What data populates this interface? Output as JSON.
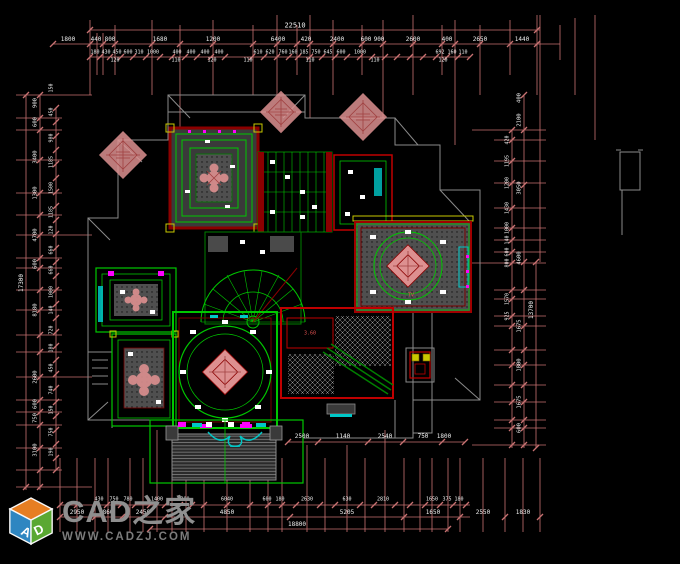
{
  "colors": {
    "background": "#000000",
    "dim_line": "#c87272",
    "dim_text": "#f0f0f0",
    "green": "#00c800",
    "green_dark": "#008000",
    "red": "#c00000",
    "red_dark": "#8b0000",
    "pink": "#dd9090",
    "magenta": "#ff00ff",
    "cyan": "#00c8c8",
    "yellow": "#c8c800",
    "gray": "#8a8a8a",
    "gray_dark": "#555555",
    "logo_text": "#8f8f8f",
    "logo_url": "#7c7c7c",
    "logo_blue": "#2e86c1",
    "logo_green": "#5aa832",
    "logo_orange": "#e67e22"
  },
  "watermark": {
    "cube_left_letter": "A",
    "cube_right_letter": "D",
    "title": "CAD之家",
    "url": "WWW.CADZJ.COM"
  },
  "plan_labels": [
    {
      "t": "3.60",
      "x": 310,
      "y": 334
    },
    {
      "t": "TV",
      "x": 411,
      "y": 296
    }
  ],
  "dimensions": {
    "horizontal": [
      {
        "t": "22510",
        "x": 295,
        "y": 26,
        "s": 7
      },
      {
        "t": "1800",
        "x": 68,
        "y": 40,
        "s": 6
      },
      {
        "t": "440",
        "x": 96,
        "y": 40,
        "s": 6
      },
      {
        "t": "800",
        "x": 110,
        "y": 40,
        "s": 6
      },
      {
        "t": "1680",
        "x": 160,
        "y": 40,
        "s": 6
      },
      {
        "t": "1200",
        "x": 213,
        "y": 40,
        "s": 6
      },
      {
        "t": "6400",
        "x": 278,
        "y": 40,
        "s": 6
      },
      {
        "t": "420",
        "x": 306,
        "y": 40,
        "s": 6
      },
      {
        "t": "2400",
        "x": 337,
        "y": 40,
        "s": 6
      },
      {
        "t": "600",
        "x": 366,
        "y": 40,
        "s": 6
      },
      {
        "t": "900",
        "x": 379,
        "y": 40,
        "s": 6
      },
      {
        "t": "2600",
        "x": 413,
        "y": 40,
        "s": 6
      },
      {
        "t": "400",
        "x": 447,
        "y": 40,
        "s": 6
      },
      {
        "t": "2650",
        "x": 480,
        "y": 40,
        "s": 6
      },
      {
        "t": "1440",
        "x": 522,
        "y": 40,
        "s": 6
      },
      {
        "t": "180",
        "x": 95,
        "y": 53,
        "s": 5
      },
      {
        "t": "430",
        "x": 106,
        "y": 53,
        "s": 5
      },
      {
        "t": "450",
        "x": 117,
        "y": 53,
        "s": 5
      },
      {
        "t": "600",
        "x": 128,
        "y": 53,
        "s": 5
      },
      {
        "t": "310",
        "x": 139,
        "y": 53,
        "s": 5
      },
      {
        "t": "1000",
        "x": 153,
        "y": 53,
        "s": 5
      },
      {
        "t": "400",
        "x": 177,
        "y": 53,
        "s": 5
      },
      {
        "t": "400",
        "x": 191,
        "y": 53,
        "s": 5
      },
      {
        "t": "400",
        "x": 205,
        "y": 53,
        "s": 5
      },
      {
        "t": "400",
        "x": 219,
        "y": 53,
        "s": 5
      },
      {
        "t": "610",
        "x": 258,
        "y": 53,
        "s": 5
      },
      {
        "t": "620",
        "x": 270,
        "y": 53,
        "s": 5
      },
      {
        "t": "760",
        "x": 283,
        "y": 53,
        "s": 5
      },
      {
        "t": "160",
        "x": 293,
        "y": 53,
        "s": 5
      },
      {
        "t": "185",
        "x": 304,
        "y": 53,
        "s": 5
      },
      {
        "t": "750",
        "x": 316,
        "y": 53,
        "s": 5
      },
      {
        "t": "645",
        "x": 328,
        "y": 53,
        "s": 5
      },
      {
        "t": "600",
        "x": 341,
        "y": 53,
        "s": 5
      },
      {
        "t": "1000",
        "x": 360,
        "y": 53,
        "s": 5
      },
      {
        "t": "692",
        "x": 440,
        "y": 53,
        "s": 5
      },
      {
        "t": "160",
        "x": 452,
        "y": 53,
        "s": 5
      },
      {
        "t": "110",
        "x": 463,
        "y": 53,
        "s": 5
      },
      {
        "t": "120",
        "x": 115,
        "y": 61,
        "s": 5
      },
      {
        "t": "110",
        "x": 176,
        "y": 61,
        "s": 5
      },
      {
        "t": "120",
        "x": 212,
        "y": 61,
        "s": 5
      },
      {
        "t": "110",
        "x": 248,
        "y": 61,
        "s": 5
      },
      {
        "t": "110",
        "x": 310,
        "y": 61,
        "s": 5
      },
      {
        "t": "110",
        "x": 375,
        "y": 61,
        "s": 5
      },
      {
        "t": "120",
        "x": 443,
        "y": 61,
        "s": 5
      },
      {
        "t": "2500",
        "x": 302,
        "y": 437,
        "s": 6
      },
      {
        "t": "1140",
        "x": 343,
        "y": 437,
        "s": 6
      },
      {
        "t": "2540",
        "x": 385,
        "y": 437,
        "s": 6
      },
      {
        "t": "750",
        "x": 423,
        "y": 437,
        "s": 6
      },
      {
        "t": "1800",
        "x": 444,
        "y": 437,
        "s": 6
      },
      {
        "t": "430",
        "x": 99,
        "y": 500,
        "s": 5
      },
      {
        "t": "750",
        "x": 114,
        "y": 500,
        "s": 5
      },
      {
        "t": "780",
        "x": 128,
        "y": 500,
        "s": 5
      },
      {
        "t": "1400",
        "x": 157,
        "y": 500,
        "s": 5
      },
      {
        "t": "300",
        "x": 185,
        "y": 500,
        "s": 5
      },
      {
        "t": "6040",
        "x": 227,
        "y": 500,
        "s": 5
      },
      {
        "t": "600",
        "x": 267,
        "y": 500,
        "s": 5
      },
      {
        "t": "180",
        "x": 280,
        "y": 500,
        "s": 5
      },
      {
        "t": "2630",
        "x": 307,
        "y": 500,
        "s": 5
      },
      {
        "t": "630",
        "x": 347,
        "y": 500,
        "s": 5
      },
      {
        "t": "2810",
        "x": 383,
        "y": 500,
        "s": 5
      },
      {
        "t": "1650",
        "x": 432,
        "y": 500,
        "s": 5
      },
      {
        "t": "375",
        "x": 447,
        "y": 500,
        "s": 5
      },
      {
        "t": "180",
        "x": 459,
        "y": 500,
        "s": 5
      },
      {
        "t": "2950",
        "x": 77,
        "y": 513,
        "s": 6
      },
      {
        "t": "860",
        "x": 108,
        "y": 513,
        "s": 6
      },
      {
        "t": "2450",
        "x": 143,
        "y": 513,
        "s": 6
      },
      {
        "t": "4850",
        "x": 227,
        "y": 513,
        "s": 6
      },
      {
        "t": "5205",
        "x": 347,
        "y": 513,
        "s": 6
      },
      {
        "t": "1650",
        "x": 433,
        "y": 513,
        "s": 6
      },
      {
        "t": "2550",
        "x": 483,
        "y": 513,
        "s": 6
      },
      {
        "t": "1830",
        "x": 523,
        "y": 513,
        "s": 6
      },
      {
        "t": "18800",
        "x": 297,
        "y": 525,
        "s": 6
      }
    ],
    "vertical": [
      {
        "t": "17300",
        "x": 22,
        "y": 283,
        "s": 6
      },
      {
        "t": "900",
        "x": 36,
        "y": 103,
        "s": 5.5
      },
      {
        "t": "600",
        "x": 36,
        "y": 122,
        "s": 5.5
      },
      {
        "t": "3400",
        "x": 36,
        "y": 157,
        "s": 5.5
      },
      {
        "t": "1300",
        "x": 36,
        "y": 193,
        "s": 5.5
      },
      {
        "t": "4700",
        "x": 36,
        "y": 235,
        "s": 5.5
      },
      {
        "t": "600",
        "x": 36,
        "y": 264,
        "s": 5.5
      },
      {
        "t": "8180",
        "x": 36,
        "y": 310,
        "s": 5.5
      },
      {
        "t": "2600",
        "x": 36,
        "y": 377,
        "s": 5.5
      },
      {
        "t": "600",
        "x": 36,
        "y": 404,
        "s": 5.5
      },
      {
        "t": "750",
        "x": 36,
        "y": 418,
        "s": 5.5
      },
      {
        "t": "3100",
        "x": 36,
        "y": 450,
        "s": 5.5
      },
      {
        "t": "150",
        "x": 52,
        "y": 88,
        "s": 5
      },
      {
        "t": "450",
        "x": 52,
        "y": 112,
        "s": 5
      },
      {
        "t": "980",
        "x": 52,
        "y": 138,
        "s": 5
      },
      {
        "t": "1185",
        "x": 52,
        "y": 162,
        "s": 5
      },
      {
        "t": "1500",
        "x": 52,
        "y": 188,
        "s": 5
      },
      {
        "t": "1185",
        "x": 52,
        "y": 212,
        "s": 5
      },
      {
        "t": "120",
        "x": 52,
        "y": 230,
        "s": 5
      },
      {
        "t": "660",
        "x": 52,
        "y": 250,
        "s": 5
      },
      {
        "t": "660",
        "x": 52,
        "y": 270,
        "s": 5
      },
      {
        "t": "1000",
        "x": 52,
        "y": 292,
        "s": 5
      },
      {
        "t": "140",
        "x": 52,
        "y": 310,
        "s": 5
      },
      {
        "t": "720",
        "x": 52,
        "y": 330,
        "s": 5
      },
      {
        "t": "180",
        "x": 52,
        "y": 348,
        "s": 5
      },
      {
        "t": "450",
        "x": 52,
        "y": 368,
        "s": 5
      },
      {
        "t": "740",
        "x": 52,
        "y": 390,
        "s": 5
      },
      {
        "t": "150",
        "x": 52,
        "y": 410,
        "s": 5
      },
      {
        "t": "750",
        "x": 52,
        "y": 432,
        "s": 5
      },
      {
        "t": "190",
        "x": 52,
        "y": 452,
        "s": 5
      },
      {
        "t": "420",
        "x": 508,
        "y": 140,
        "s": 5
      },
      {
        "t": "1195",
        "x": 508,
        "y": 161,
        "s": 5
      },
      {
        "t": "1200",
        "x": 508,
        "y": 183,
        "s": 5
      },
      {
        "t": "1430",
        "x": 508,
        "y": 208,
        "s": 5
      },
      {
        "t": "1000",
        "x": 508,
        "y": 228,
        "s": 5
      },
      {
        "t": "140",
        "x": 508,
        "y": 240,
        "s": 5
      },
      {
        "t": "600",
        "x": 508,
        "y": 252,
        "s": 5
      },
      {
        "t": "800",
        "x": 508,
        "y": 263,
        "s": 5
      },
      {
        "t": "1570",
        "x": 508,
        "y": 299,
        "s": 5
      },
      {
        "t": "925",
        "x": 508,
        "y": 316,
        "s": 5
      },
      {
        "t": "400",
        "x": 520,
        "y": 98,
        "s": 5.5
      },
      {
        "t": "2100",
        "x": 520,
        "y": 120,
        "s": 5.5
      },
      {
        "t": "3050",
        "x": 520,
        "y": 188,
        "s": 5.5
      },
      {
        "t": "4600",
        "x": 520,
        "y": 258,
        "s": 5.5
      },
      {
        "t": "1675",
        "x": 520,
        "y": 326,
        "s": 5.5
      },
      {
        "t": "1800",
        "x": 520,
        "y": 365,
        "s": 5.5
      },
      {
        "t": "1675",
        "x": 520,
        "y": 402,
        "s": 5.5
      },
      {
        "t": "600",
        "x": 520,
        "y": 428,
        "s": 5.5
      },
      {
        "t": "13700",
        "x": 532,
        "y": 310,
        "s": 6
      }
    ]
  }
}
